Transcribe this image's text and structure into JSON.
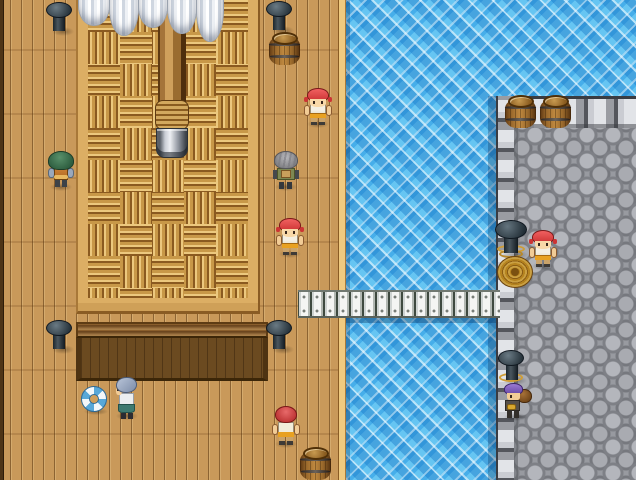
{
  "scene": {
    "style": "top-down pixel RPG map",
    "setting": "wooden ship deck docked beside a stone pier with a plank gangway over water",
    "viewport": {
      "width": 636,
      "height": 480
    },
    "text_visible": "none"
  },
  "palette": {
    "deck_wood": "#c9995a",
    "deck_trim": "#f0ca80",
    "rope_mat": "#d2a85e",
    "hatch_wood": "#6b4a20",
    "water_blue": "#46aeea",
    "pier_stone": "#989aa0",
    "pier_edge_block": "#caccd2",
    "gangplank": "#eef0ee",
    "sail_white": "#eef1f5",
    "sailor_bandana_red": "#cc3434",
    "porter_turban_purple": "#6a4aa8",
    "barrel_brown": "#9c6a2c",
    "rope_gold": "#caa043"
  },
  "entities": [
    {
      "kind": "sail",
      "name": "furled-sail-1",
      "interactable": false,
      "x": 78,
      "y": -2,
      "w": 32,
      "h": 28
    },
    {
      "kind": "sail",
      "name": "furled-sail-2",
      "interactable": false,
      "x": 109,
      "y": -2,
      "w": 30,
      "h": 38
    },
    {
      "kind": "sail",
      "name": "furled-sail-3",
      "interactable": false,
      "x": 138,
      "y": -2,
      "w": 30,
      "h": 30
    },
    {
      "kind": "sail",
      "name": "furled-sail-4",
      "interactable": false,
      "x": 167,
      "y": -2,
      "w": 30,
      "h": 36
    },
    {
      "kind": "sail",
      "name": "furled-sail-5",
      "interactable": false,
      "x": 196,
      "y": -2,
      "w": 28,
      "h": 44
    },
    {
      "kind": "bollard",
      "name": "bollard-deck-top-left",
      "interactable": false,
      "x": 45,
      "y": 2,
      "w": 28,
      "h": 34
    },
    {
      "kind": "bollard",
      "name": "bollard-deck-top-center",
      "interactable": false,
      "x": 265,
      "y": 1,
      "w": 28,
      "h": 34
    },
    {
      "kind": "barrel",
      "name": "barrel-deck-top",
      "interactable": false,
      "x": 268,
      "y": 32,
      "w": 33,
      "h": 33
    },
    {
      "kind": "barrel",
      "name": "barrel-pier-left",
      "interactable": false,
      "x": 504,
      "y": 95,
      "w": 34,
      "h": 34
    },
    {
      "kind": "barrel",
      "name": "barrel-pier-right",
      "interactable": false,
      "x": 539,
      "y": 95,
      "w": 34,
      "h": 34
    },
    {
      "kind": "sailor-down",
      "name": "sailor-upper-deck",
      "interactable": true,
      "x": 302,
      "y": 86,
      "w": 32,
      "h": 42
    },
    {
      "kind": "green-up",
      "name": "green-haired-villager",
      "interactable": true,
      "x": 45,
      "y": 151,
      "w": 32,
      "h": 40
    },
    {
      "kind": "gray-up",
      "name": "gray-haired-villager",
      "interactable": true,
      "x": 271,
      "y": 151,
      "w": 30,
      "h": 40
    },
    {
      "kind": "sailor-down",
      "name": "sailor-mid-deck",
      "interactable": true,
      "x": 274,
      "y": 216,
      "w": 32,
      "h": 42
    },
    {
      "kind": "bollard-rope",
      "name": "pier-bollard-with-rope",
      "interactable": false,
      "x": 494,
      "y": 220,
      "w": 34,
      "h": 40
    },
    {
      "kind": "rope-coil",
      "name": "rope-coil",
      "interactable": false,
      "x": 497,
      "y": 256,
      "w": 36,
      "h": 32
    },
    {
      "kind": "sailor-down",
      "name": "sailor-pier",
      "interactable": true,
      "x": 527,
      "y": 228,
      "w": 32,
      "h": 42
    },
    {
      "kind": "bollard",
      "name": "bollard-deck-bottom-left",
      "interactable": false,
      "x": 45,
      "y": 320,
      "w": 28,
      "h": 34
    },
    {
      "kind": "bollard",
      "name": "bollard-deck-bottom-center",
      "interactable": false,
      "x": 265,
      "y": 320,
      "w": 28,
      "h": 34
    },
    {
      "kind": "bollard-gold",
      "name": "pier-bollard-lower",
      "interactable": false,
      "x": 497,
      "y": 350,
      "w": 30,
      "h": 36
    },
    {
      "kind": "porter-down",
      "name": "porter-with-sack",
      "interactable": true,
      "x": 501,
      "y": 379,
      "w": 32,
      "h": 42
    },
    {
      "kind": "life-ring",
      "name": "life-ring",
      "interactable": false,
      "x": 81,
      "y": 384,
      "w": 28,
      "h": 31
    },
    {
      "kind": "maid-left",
      "name": "blue-haired-attendant",
      "interactable": true,
      "x": 112,
      "y": 376,
      "w": 30,
      "h": 44
    },
    {
      "kind": "sailor-up",
      "name": "sailor-lower-deck",
      "interactable": true,
      "x": 271,
      "y": 404,
      "w": 30,
      "h": 44
    },
    {
      "kind": "barrel",
      "name": "barrel-deck-bottom",
      "interactable": false,
      "x": 299,
      "y": 447,
      "w": 33,
      "h": 33
    }
  ]
}
